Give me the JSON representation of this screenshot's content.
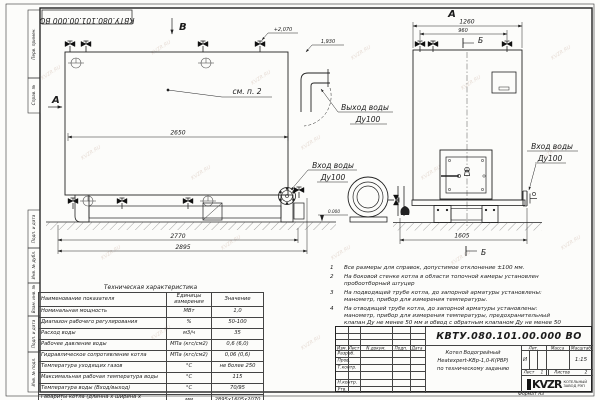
{
  "watermark": "KVZR.RU",
  "frame": {
    "stamp": "КВТУ.080.101.00.000  ВО",
    "left_labels": [
      "Перв. примен.",
      "Справ. №",
      "Подп. и дата",
      "Инв. № дубл.",
      "Взам. инв. №",
      "Подп. и дата",
      "Инв. № подл."
    ]
  },
  "drawing": {
    "view_b": "В",
    "section_a": "А",
    "view_a_front": "А",
    "sec_b_top": "Б",
    "sec_b_bottom": "Б",
    "elev_top": "+2,070",
    "elev_pipe": "1,930",
    "level_zero": "0.000",
    "dim_2650": "2650",
    "dim_2770": "2770",
    "dim_2895": "2895",
    "dim_1260": "1260",
    "dim_960": "960",
    "dim_1605": "1605",
    "see_note": "см. п. 2",
    "outlet_line1": "Выход воды",
    "outlet_line2": "Ду100",
    "inlet_line1": "Вход воды",
    "inlet_line2": "Ду100"
  },
  "notes": {
    "items": [
      {
        "n": "1",
        "t": "Все размеры для справок, допустимое отклонение ±100 мм."
      },
      {
        "n": "2",
        "t": "На боковой стенке котла в области топочной камеры установлен пробоотборный штуцер"
      },
      {
        "n": "3",
        "t": "На подводящей трубе котла, до запорной арматуры установлены: манометр, прибор для измерения температуры."
      },
      {
        "n": "4",
        "t": "На отводящей трубе котла, до запорной арматуры установлены: манометр, прибор для измерения температуры, предохранительный клапан Ду не менее 50 мм и обвод с обратным клапаном Ду не менее 50 мм."
      }
    ]
  },
  "tech_table": {
    "title": "Техническая характеристика",
    "headers": [
      "Наименование показателя",
      "Единицы измерения",
      "Значение"
    ],
    "rows": [
      [
        "Номинальная мощность",
        "МВт",
        "1,0"
      ],
      [
        "Диапазон рабочего регулирования",
        "%",
        "50-100"
      ],
      [
        "Расход воды",
        "м3/ч",
        "35"
      ],
      [
        "Рабочее давление воды",
        "МПа (кгс/см2)",
        "0,6 (6,0)"
      ],
      [
        "Гидравлическое сопротивление котла",
        "МПа (кгс/см2)",
        "0,06 (0,6)"
      ],
      [
        "Температура уходящих газов",
        "°С",
        "не более 250"
      ],
      [
        "Максимальная рабочая температура воды",
        "°С",
        "115"
      ],
      [
        "Температура воды (Вход/выход)",
        "°С",
        "70/95"
      ],
      [
        "Габариты котла (длинна х ширина х высота)",
        "мм",
        "2895х1605х2070"
      ]
    ]
  },
  "title_block": {
    "doc_number": "КВТУ.080.101.00.000  ВО",
    "rev_headers": [
      "Изм.",
      "Лист",
      "N докум.",
      "Подп.",
      "Дата"
    ],
    "row_labels": [
      "Разраб.",
      "Пров.",
      "Т.контр.",
      "Н.контр.",
      "Утв."
    ],
    "description": [
      "Котел Водогрейный",
      "Heatexpert-КВр-1,0-К(РВР)",
      "по техническому заданию"
    ],
    "lit_header": "Лит.",
    "mass_header": "Масса",
    "scale_header": "Масштаб",
    "lit_value": "И",
    "scale_value": "1:15",
    "sheet_label": "Лист",
    "sheet_value": "1",
    "sheets_label": "Листов",
    "sheets_value": "2",
    "logo_text": "KVZR",
    "logo_sub1": "КОТЕЛЬНЫЙ",
    "logo_sub2": "ЗАВОД РЭП",
    "format_label": "Формат  А3"
  }
}
